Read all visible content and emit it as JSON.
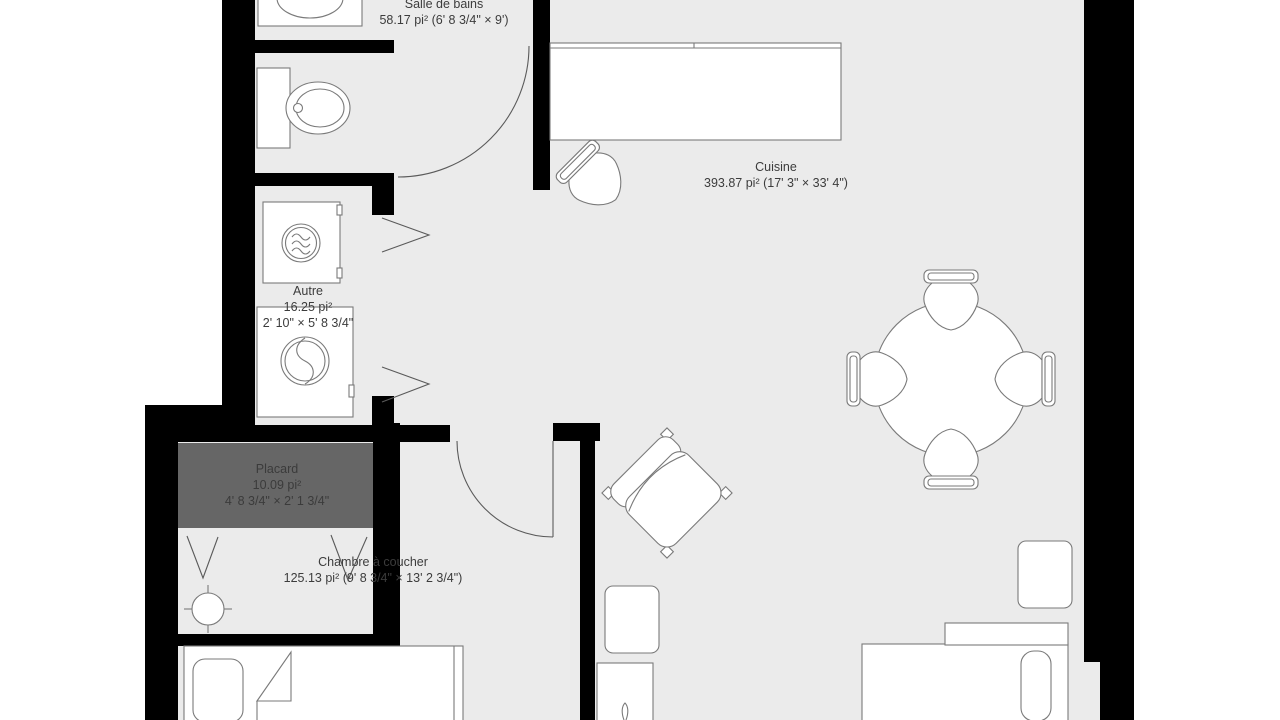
{
  "app": {
    "view": "floor-plan"
  },
  "rooms": {
    "bathroom": {
      "name": "Salle de bains",
      "details": "58.17 pi² (6' 8 3/4\" × 9')"
    },
    "kitchen": {
      "name": "Cuisine",
      "details": "393.87 pi² (17' 3\" × 33' 4\")"
    },
    "other": {
      "name": "Autre",
      "area": "16.25 pi²",
      "dimensions": "2' 10\" × 5' 8 3/4\""
    },
    "closet": {
      "name": "Placard",
      "area": "10.09 pi²",
      "dimensions": "4' 8 3/4\" × 2' 1 3/4\""
    },
    "bedroom": {
      "name": "Chambre à coucher",
      "details": "125.13 pi² (9' 8 3/4\" × 13' 2 3/4\")"
    }
  },
  "furniture": [
    "bathroom-sink",
    "toilet",
    "dryer",
    "washing-machine",
    "kitchen-counter",
    "kitchen-chair",
    "dining-table",
    "dining-chairs",
    "armchair",
    "ceiling-light",
    "nightstand",
    "desk",
    "bed-left",
    "bed-right"
  ],
  "colors": {
    "floor": "#ebebeb",
    "wall": "#000000",
    "line": "#7a7a7a",
    "door_line": "#5a5a5a",
    "closet_fill": "#666666",
    "closet_text": "#3b3b3b",
    "label_text": "#3c3c3c",
    "furniture_fill": "#ffffff"
  }
}
